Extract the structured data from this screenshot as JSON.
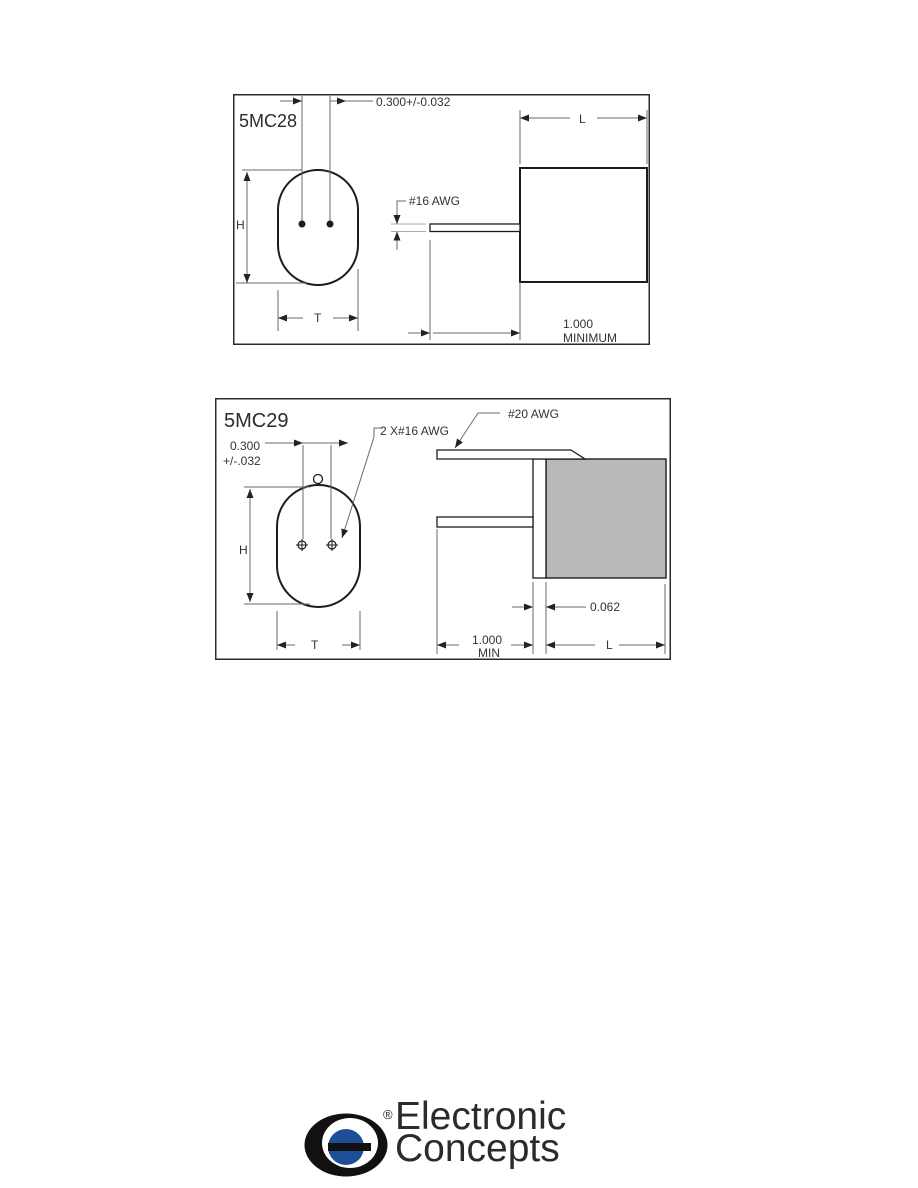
{
  "page": {
    "background": "#ffffff"
  },
  "diagram1": {
    "model": "5MC28",
    "dims": {
      "lead_spacing": "0.300+/-0.032",
      "height": "H",
      "thickness": "T",
      "length": "L",
      "wire_gauge": "#16 AWG",
      "lead_length_1": "1.000",
      "lead_length_2": "MINIMUM"
    }
  },
  "diagram2": {
    "model": "5MC29",
    "dims": {
      "lead_spacing_1": "0.300",
      "lead_spacing_2": "+/-.032",
      "height": "H",
      "thickness": "T",
      "length": "L",
      "leads_gauge": "2 X#16 AWG",
      "tab_gauge": "#20 AWG",
      "end_margin": "0.062",
      "lead_length_1": "1.000",
      "lead_length_2": "MIN"
    }
  },
  "logo": {
    "name_line1": "Electronic",
    "name_line2": "Concepts",
    "registered_mark": "®",
    "colors": {
      "mark_black": "#111111",
      "dot_blue": "#1e4f96",
      "text": "#2a2a2f"
    }
  },
  "colors": {
    "outline": "#1c1c1c",
    "dimension_lines": "#6a6a6a",
    "body_fill": "#b9b9b9",
    "frame": "#2b2b2b"
  }
}
